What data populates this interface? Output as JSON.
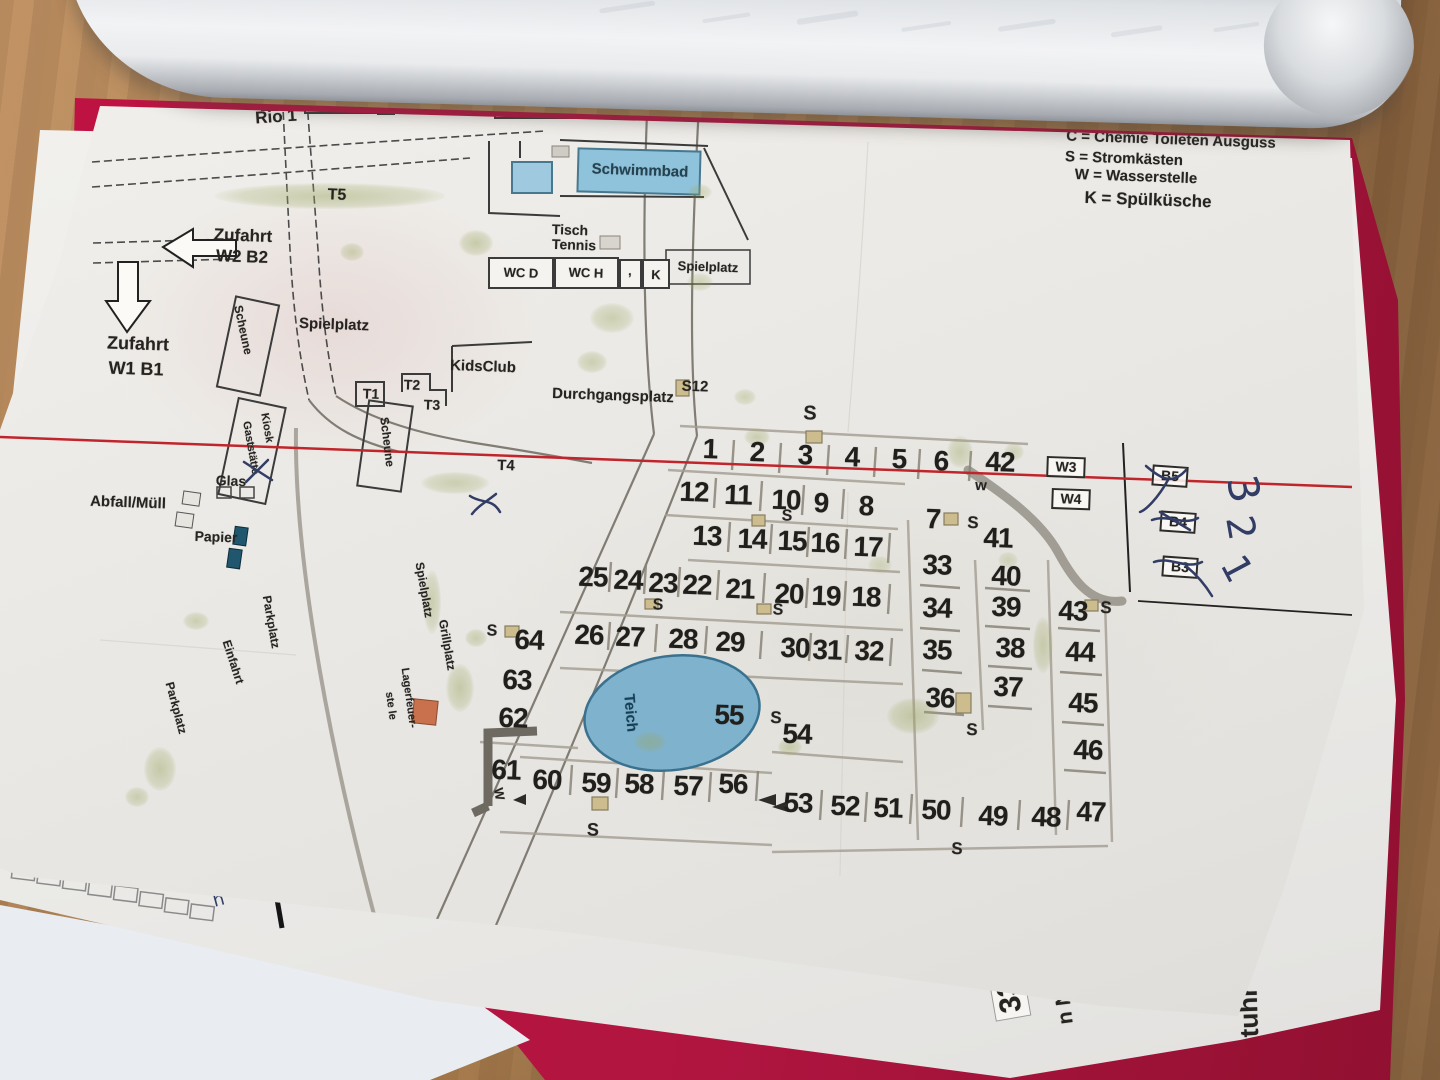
{
  "colors": {
    "paper": "#edebe7",
    "cover_red": "#b01540",
    "wood": "#b3895c",
    "red_line": "#c0252c",
    "ink_blue": "#323d66",
    "pond_blue": "#7fb2cc",
    "pool_blue": "#8fc3dc",
    "tree_green": "#9aa55f"
  },
  "legend": {
    "line_c": "C = Chemie Toileten Ausguss",
    "line_s": "S = Stromkästen",
    "line_w": "W = Wasserstelle",
    "line_k": "K = Spülküsche"
  },
  "map": {
    "labels": [
      {
        "name": "label-rio2",
        "t": "Rio 2",
        "x": 339,
        "y": 98,
        "fs": 18,
        "cls": "box"
      },
      {
        "name": "label-rio1",
        "t": "Rio 1",
        "x": 276,
        "y": 117,
        "fs": 17,
        "rot": -4
      },
      {
        "name": "label-damen",
        "t": "Damen",
        "x": 517,
        "y": 104,
        "fs": 14
      },
      {
        "name": "label-herren",
        "t": "Herren",
        "x": 564,
        "y": 104,
        "fs": 14
      },
      {
        "name": "label-schwimmbad",
        "t": "Schwimmbad",
        "x": 640,
        "y": 171,
        "fs": 15,
        "cls": "pool-label"
      },
      {
        "name": "label-t5",
        "t": "T5",
        "x": 337,
        "y": 196,
        "fs": 16
      },
      {
        "name": "label-zufahrt-w2",
        "t": "Zufahrt",
        "x": 243,
        "y": 236,
        "fs": 17
      },
      {
        "name": "label-w2b2",
        "t": "W2 B2",
        "x": 242,
        "y": 257,
        "fs": 17
      },
      {
        "name": "label-zufahrt-w1",
        "t": "Zufahrt",
        "x": 138,
        "y": 344,
        "fs": 18
      },
      {
        "name": "label-w1b1",
        "t": "W1 B1",
        "x": 136,
        "y": 369,
        "fs": 18
      },
      {
        "name": "label-tisch",
        "t": "Tisch",
        "x": 570,
        "y": 230,
        "fs": 14
      },
      {
        "name": "label-tennis",
        "t": "Tennis",
        "x": 574,
        "y": 245,
        "fs": 14
      },
      {
        "name": "label-wcd",
        "t": "WC D",
        "x": 521,
        "y": 273,
        "fs": 13
      },
      {
        "name": "label-wch",
        "t": "WC H",
        "x": 586,
        "y": 273,
        "fs": 13
      },
      {
        "name": "label-comma-box",
        "t": ",",
        "x": 630,
        "y": 271,
        "fs": 13
      },
      {
        "name": "label-k-box",
        "t": "K",
        "x": 656,
        "y": 275,
        "fs": 13
      },
      {
        "name": "label-spielplatz-top",
        "t": "Spielplatz",
        "x": 708,
        "y": 267,
        "fs": 13
      },
      {
        "name": "label-spielplatz-left",
        "t": "Spielplatz",
        "x": 334,
        "y": 325,
        "fs": 15
      },
      {
        "name": "label-scheune-1",
        "t": "Scheune",
        "x": 243,
        "y": 330,
        "fs": 12,
        "rot": 78
      },
      {
        "name": "label-kidsclub",
        "t": "KidsClub",
        "x": 483,
        "y": 367,
        "fs": 15
      },
      {
        "name": "label-t1",
        "t": "T1",
        "x": 371,
        "y": 394,
        "fs": 14
      },
      {
        "name": "label-t2",
        "t": "T2",
        "x": 412,
        "y": 385,
        "fs": 14
      },
      {
        "name": "label-t3",
        "t": "T3",
        "x": 432,
        "y": 405,
        "fs": 14
      },
      {
        "name": "label-durchgangsplatz",
        "t": "Durchgangsplatz",
        "x": 613,
        "y": 396,
        "fs": 15
      },
      {
        "name": "label-s12",
        "t": "S12",
        "x": 695,
        "y": 387,
        "fs": 15
      },
      {
        "name": "label-kiosk",
        "t": "Kiosk",
        "x": 266,
        "y": 428,
        "fs": 11,
        "rot": 80
      },
      {
        "name": "label-gaststaette",
        "t": "Gaststätte",
        "x": 250,
        "y": 448,
        "fs": 11,
        "rot": 80
      },
      {
        "name": "label-scheune-2",
        "t": "Scheune",
        "x": 387,
        "y": 442,
        "fs": 12,
        "rot": 83
      },
      {
        "name": "label-t4",
        "t": "T4",
        "x": 506,
        "y": 466,
        "fs": 15
      },
      {
        "name": "label-glas",
        "t": "Glas",
        "x": 231,
        "y": 481,
        "fs": 14
      },
      {
        "name": "label-abfall-muell",
        "t": "Abfall/Müll",
        "x": 128,
        "y": 503,
        "fs": 15
      },
      {
        "name": "label-papier",
        "t": "Papier",
        "x": 216,
        "y": 537,
        "fs": 14
      },
      {
        "name": "label-parkplatz-1",
        "t": "Parkplatz",
        "x": 271,
        "y": 622,
        "fs": 12,
        "rot": 80
      },
      {
        "name": "label-einfahrt",
        "t": "Einfahrt",
        "x": 233,
        "y": 662,
        "fs": 12,
        "rot": 72
      },
      {
        "name": "label-parkplatz-2",
        "t": "Parkplatz",
        "x": 176,
        "y": 708,
        "fs": 12,
        "rot": 75
      },
      {
        "name": "label-spielplatz-vert",
        "t": "Spielplatz",
        "x": 424,
        "y": 590,
        "fs": 12,
        "rot": 80
      },
      {
        "name": "label-grillplatz",
        "t": "Grillplatz",
        "x": 447,
        "y": 645,
        "fs": 12,
        "rot": 80
      },
      {
        "name": "label-lagerfeuer-1",
        "t": "Lagerfeuer-",
        "x": 408,
        "y": 698,
        "fs": 11,
        "rot": 82
      },
      {
        "name": "label-lagerfeuer-2",
        "t": "ste le",
        "x": 390,
        "y": 706,
        "fs": 11,
        "rot": 82
      },
      {
        "name": "label-teich",
        "t": "Teich",
        "x": 630,
        "y": 713,
        "fs": 15,
        "rot": 85,
        "cls": "teich-label"
      },
      {
        "name": "label-w3",
        "t": "W3",
        "x": 1066,
        "y": 467,
        "fs": 14,
        "cls": "box"
      },
      {
        "name": "label-w4",
        "t": "W4",
        "x": 1071,
        "y": 499,
        "fs": 14,
        "cls": "box"
      },
      {
        "name": "label-b5",
        "t": "B5",
        "x": 1170,
        "y": 476,
        "fs": 14,
        "rot": 4,
        "cls": "box"
      },
      {
        "name": "label-b4",
        "t": "B4",
        "x": 1178,
        "y": 522,
        "fs": 14,
        "rot": 4,
        "cls": "box"
      },
      {
        "name": "label-b3",
        "t": "B3",
        "x": 1180,
        "y": 567,
        "fs": 14,
        "rot": 4,
        "cls": "box"
      },
      {
        "name": "label-w-lowercase",
        "t": "w",
        "x": 981,
        "y": 486,
        "fs": 15
      },
      {
        "name": "label-w-61",
        "t": "W",
        "x": 499,
        "y": 794,
        "fs": 13,
        "rot": 80
      },
      {
        "name": "legend-line-c",
        "t": "C = Chemie Toileten Ausguss",
        "x": 1171,
        "y": 140,
        "fs": 15
      },
      {
        "name": "legend-line-s",
        "t": "S = Stromkästen",
        "x": 1124,
        "y": 159,
        "fs": 15
      },
      {
        "name": "legend-line-w",
        "t": "W = Wasserstelle",
        "x": 1136,
        "y": 177,
        "fs": 15
      },
      {
        "name": "legend-line-k",
        "t": "K = Spülküsche",
        "x": 1148,
        "y": 200,
        "fs": 17
      },
      {
        "name": "handwritten-3",
        "t": "3",
        "x": 1243,
        "y": 489,
        "fs": 42,
        "rot": 78,
        "cls": "hand"
      },
      {
        "name": "handwritten-2",
        "t": "2",
        "x": 1240,
        "y": 528,
        "fs": 38,
        "rot": 80,
        "cls": "hand"
      },
      {
        "name": "handwritten-1",
        "t": "1",
        "x": 1236,
        "y": 569,
        "fs": 38,
        "rot": 62,
        "cls": "hand"
      }
    ],
    "pitches": [
      {
        "n": "1",
        "x": 710,
        "y": 449
      },
      {
        "n": "2",
        "x": 757,
        "y": 452
      },
      {
        "n": "3",
        "x": 805,
        "y": 455
      },
      {
        "n": "4",
        "x": 852,
        "y": 457
      },
      {
        "n": "5",
        "x": 899,
        "y": 459
      },
      {
        "n": "6",
        "x": 941,
        "y": 461
      },
      {
        "n": "42",
        "x": 1000,
        "y": 462
      },
      {
        "n": "12",
        "x": 694,
        "y": 492
      },
      {
        "n": "11",
        "x": 738,
        "y": 495
      },
      {
        "n": "10",
        "x": 786,
        "y": 500
      },
      {
        "n": "9",
        "x": 821,
        "y": 503
      },
      {
        "n": "8",
        "x": 866,
        "y": 506
      },
      {
        "n": "7",
        "x": 933,
        "y": 519
      },
      {
        "n": "41",
        "x": 998,
        "y": 538
      },
      {
        "n": "13",
        "x": 707,
        "y": 536
      },
      {
        "n": "14",
        "x": 752,
        "y": 539
      },
      {
        "n": "15",
        "x": 792,
        "y": 541
      },
      {
        "n": "16",
        "x": 825,
        "y": 543
      },
      {
        "n": "17",
        "x": 868,
        "y": 547
      },
      {
        "n": "33",
        "x": 937,
        "y": 565
      },
      {
        "n": "40",
        "x": 1006,
        "y": 576
      },
      {
        "n": "25",
        "x": 593,
        "y": 577
      },
      {
        "n": "24",
        "x": 628,
        "y": 580
      },
      {
        "n": "23",
        "x": 663,
        "y": 583
      },
      {
        "n": "22",
        "x": 697,
        "y": 585
      },
      {
        "n": "21",
        "x": 740,
        "y": 589
      },
      {
        "n": "20",
        "x": 789,
        "y": 594
      },
      {
        "n": "19",
        "x": 826,
        "y": 596
      },
      {
        "n": "18",
        "x": 866,
        "y": 597
      },
      {
        "n": "34",
        "x": 937,
        "y": 608
      },
      {
        "n": "39",
        "x": 1006,
        "y": 607
      },
      {
        "n": "43",
        "x": 1073,
        "y": 611
      },
      {
        "n": "26",
        "x": 589,
        "y": 635
      },
      {
        "n": "27",
        "x": 630,
        "y": 637
      },
      {
        "n": "28",
        "x": 683,
        "y": 639
      },
      {
        "n": "29",
        "x": 730,
        "y": 642
      },
      {
        "n": "30",
        "x": 795,
        "y": 648
      },
      {
        "n": "31",
        "x": 827,
        "y": 650
      },
      {
        "n": "32",
        "x": 869,
        "y": 651
      },
      {
        "n": "35",
        "x": 937,
        "y": 650
      },
      {
        "n": "38",
        "x": 1010,
        "y": 648
      },
      {
        "n": "44",
        "x": 1080,
        "y": 652
      },
      {
        "n": "36",
        "x": 940,
        "y": 698
      },
      {
        "n": "37",
        "x": 1008,
        "y": 687
      },
      {
        "n": "45",
        "x": 1083,
        "y": 703
      },
      {
        "n": "46",
        "x": 1088,
        "y": 750
      },
      {
        "n": "64",
        "x": 529,
        "y": 640
      },
      {
        "n": "63",
        "x": 517,
        "y": 680
      },
      {
        "n": "62",
        "x": 513,
        "y": 718
      },
      {
        "n": "61",
        "x": 506,
        "y": 770
      },
      {
        "n": "60",
        "x": 547,
        "y": 780
      },
      {
        "n": "59",
        "x": 596,
        "y": 783
      },
      {
        "n": "58",
        "x": 639,
        "y": 784
      },
      {
        "n": "57",
        "x": 688,
        "y": 786
      },
      {
        "n": "56",
        "x": 733,
        "y": 784
      },
      {
        "n": "55",
        "x": 729,
        "y": 715
      },
      {
        "n": "54",
        "x": 797,
        "y": 734
      },
      {
        "n": "53",
        "x": 798,
        "y": 803
      },
      {
        "n": "52",
        "x": 845,
        "y": 806
      },
      {
        "n": "51",
        "x": 888,
        "y": 808
      },
      {
        "n": "50",
        "x": 936,
        "y": 810
      },
      {
        "n": "49",
        "x": 993,
        "y": 816
      },
      {
        "n": "48",
        "x": 1046,
        "y": 817
      },
      {
        "n": "47",
        "x": 1091,
        "y": 812
      }
    ],
    "s_marks": [
      {
        "t": "S",
        "x": 810,
        "y": 414,
        "fs": 20
      },
      {
        "t": "S",
        "x": 787,
        "y": 517,
        "fs": 16
      },
      {
        "t": "S",
        "x": 973,
        "y": 523,
        "fs": 17
      },
      {
        "t": "S",
        "x": 658,
        "y": 606,
        "fs": 16
      },
      {
        "t": "S",
        "x": 778,
        "y": 611,
        "fs": 16
      },
      {
        "t": "S",
        "x": 1106,
        "y": 608,
        "fs": 17
      },
      {
        "t": "S",
        "x": 492,
        "y": 632,
        "fs": 16
      },
      {
        "t": "S",
        "x": 776,
        "y": 718,
        "fs": 17
      },
      {
        "t": "S",
        "x": 972,
        "y": 730,
        "fs": 17
      },
      {
        "t": "S",
        "x": 593,
        "y": 830,
        "fs": 18
      },
      {
        "t": "S",
        "x": 957,
        "y": 849,
        "fs": 17
      }
    ],
    "trees": [
      {
        "x": 330,
        "y": 196,
        "rx": 115,
        "ry": 13,
        "o": 0.45
      },
      {
        "x": 352,
        "y": 252,
        "rx": 12,
        "ry": 9,
        "o": 0.4
      },
      {
        "x": 476,
        "y": 243,
        "rx": 17,
        "ry": 13,
        "o": 0.45
      },
      {
        "x": 612,
        "y": 318,
        "rx": 22,
        "ry": 15,
        "o": 0.4
      },
      {
        "x": 592,
        "y": 362,
        "rx": 15,
        "ry": 11,
        "o": 0.4
      },
      {
        "x": 700,
        "y": 282,
        "rx": 13,
        "ry": 9,
        "o": 0.35
      },
      {
        "x": 757,
        "y": 437,
        "rx": 13,
        "ry": 9,
        "o": 0.4
      },
      {
        "x": 960,
        "y": 452,
        "rx": 13,
        "ry": 16,
        "o": 0.4
      },
      {
        "x": 1014,
        "y": 452,
        "rx": 10,
        "ry": 9,
        "o": 0.35
      },
      {
        "x": 455,
        "y": 483,
        "rx": 34,
        "ry": 11,
        "o": 0.4
      },
      {
        "x": 432,
        "y": 602,
        "rx": 9,
        "ry": 32,
        "o": 0.4
      },
      {
        "x": 460,
        "y": 688,
        "rx": 14,
        "ry": 24,
        "o": 0.45
      },
      {
        "x": 476,
        "y": 638,
        "rx": 11,
        "ry": 9,
        "o": 0.4
      },
      {
        "x": 913,
        "y": 716,
        "rx": 26,
        "ry": 18,
        "o": 0.45
      },
      {
        "x": 1043,
        "y": 645,
        "rx": 10,
        "ry": 28,
        "o": 0.4
      },
      {
        "x": 650,
        "y": 742,
        "rx": 16,
        "ry": 10,
        "o": 0.4
      },
      {
        "x": 790,
        "y": 747,
        "rx": 12,
        "ry": 9,
        "o": 0.4
      },
      {
        "x": 160,
        "y": 769,
        "rx": 16,
        "ry": 22,
        "o": 0.45
      },
      {
        "x": 196,
        "y": 621,
        "rx": 13,
        "ry": 9,
        "o": 0.4
      },
      {
        "x": 137,
        "y": 797,
        "rx": 12,
        "ry": 10,
        "o": 0.4
      },
      {
        "x": 700,
        "y": 192,
        "rx": 12,
        "ry": 8,
        "o": 0.35
      },
      {
        "x": 745,
        "y": 397,
        "rx": 11,
        "ry": 8,
        "o": 0.35
      },
      {
        "x": 880,
        "y": 565,
        "rx": 12,
        "ry": 9,
        "o": 0.3
      },
      {
        "x": 1008,
        "y": 560,
        "rx": 10,
        "ry": 8,
        "o": 0.3
      }
    ]
  },
  "underpage": {
    "texts": [
      {
        "name": "underpage-number-339",
        "t": "339",
        "x": 1008,
        "y": 988,
        "fs": 30,
        "rot": -100,
        "cls": "ubox"
      },
      {
        "name": "underpage-label-nr",
        "t": "n Nr.",
        "x": 1064,
        "y": 1001,
        "fs": 21,
        "rot": -97
      },
      {
        "name": "underpage-label-tuhr",
        "t": "tuhr",
        "x": 1249,
        "y": 1012,
        "fs": 26,
        "rot": -92
      },
      {
        "name": "underpage-hand-mark",
        "t": "h",
        "x": 219,
        "y": 901,
        "fs": 18,
        "rot": -15,
        "cls": "hand"
      }
    ]
  }
}
